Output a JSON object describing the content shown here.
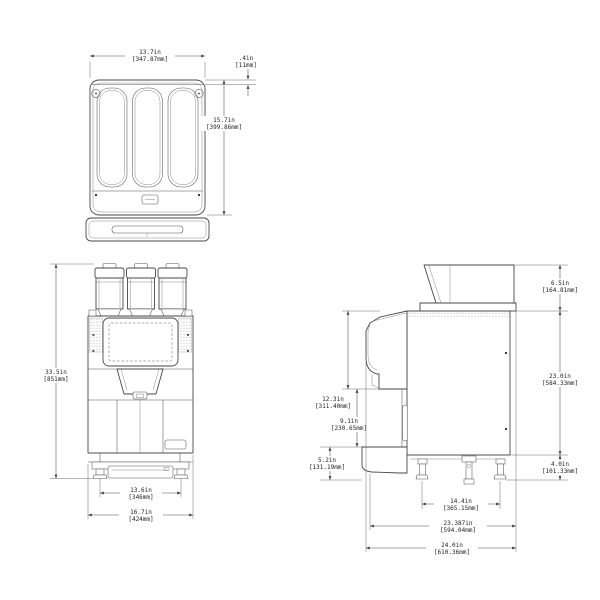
{
  "dims": {
    "top_width": {
      "in": "13.7in",
      "mm": "[347.87mm]"
    },
    "top_offset": {
      "in": ".4in",
      "mm": "[11mm]"
    },
    "top_depth": {
      "in": "15.7in",
      "mm": "[399.86mm]"
    },
    "front_height": {
      "in": "33.5in",
      "mm": "[851mm]"
    },
    "front_leg_span": {
      "in": "13.6in",
      "mm": "[346mm]"
    },
    "front_width": {
      "in": "16.7in",
      "mm": "[424mm]"
    },
    "side_hopper_height": {
      "in": "6.5in",
      "mm": "[164.81mm]"
    },
    "side_body_height": {
      "in": "23.0in",
      "mm": "[584.33mm]"
    },
    "side_leg_height": {
      "in": "4.0in",
      "mm": "[101.33mm]"
    },
    "side_door_height": {
      "in": "12.3in",
      "mm": "[311.40mm]"
    },
    "side_clearance": {
      "in": "9.1in",
      "mm": "[230.65mm]"
    },
    "side_base_height": {
      "in": "5.2in",
      "mm": "[131.19mm]"
    },
    "side_leg_span": {
      "in": "14.4in",
      "mm": "[365.15mm]"
    },
    "side_depth_body": {
      "in": "23.387in",
      "mm": "[594.04mm]"
    },
    "side_depth_overall": {
      "in": "24.0in",
      "mm": "[610.36mm]"
    }
  }
}
